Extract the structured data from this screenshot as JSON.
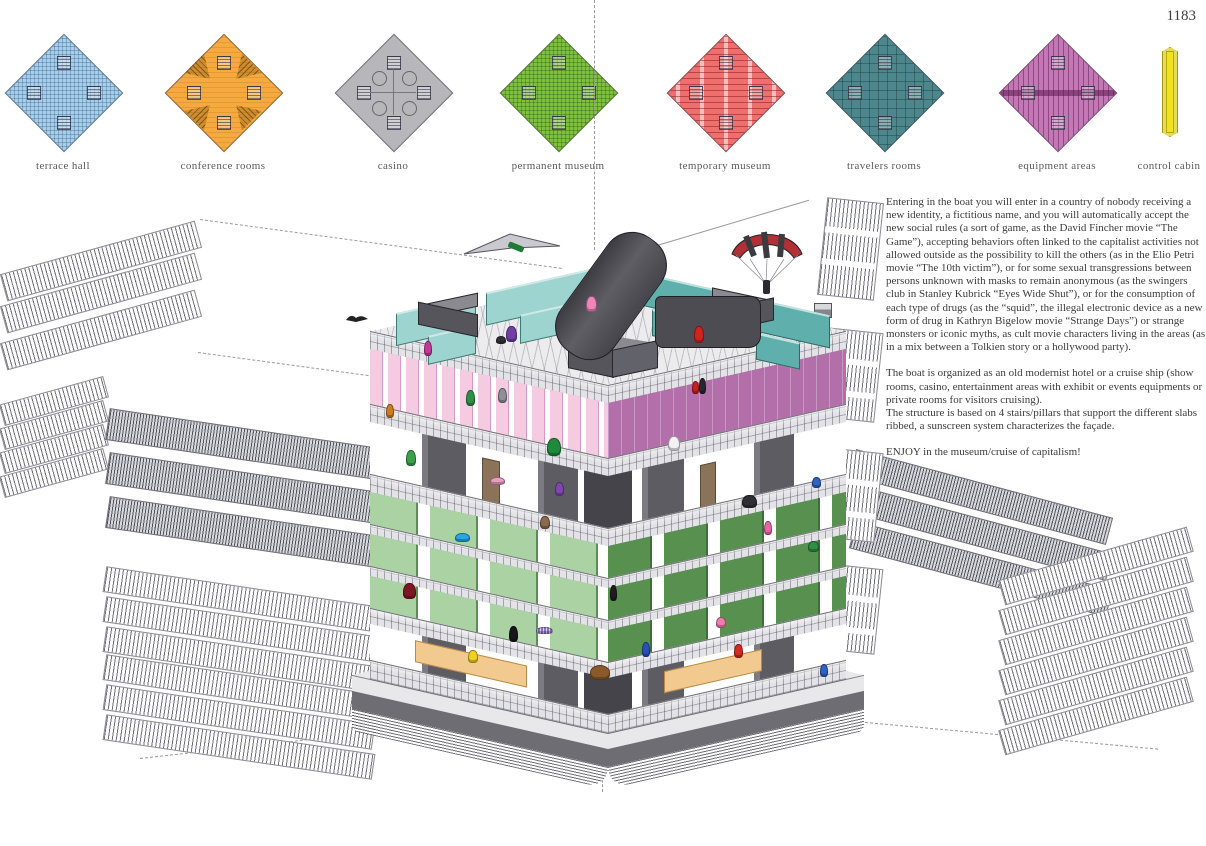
{
  "page": {
    "number": "1183"
  },
  "legend": {
    "items": [
      {
        "id": "terrace-hall",
        "label": "terrace hall",
        "color": "#a5cfe8",
        "pattern": "crosshatch-blue"
      },
      {
        "id": "conference-rooms",
        "label": "conference rooms",
        "color": "#f5a93e",
        "pattern": "fans"
      },
      {
        "id": "casino",
        "label": "casino",
        "color": "#b7b7bb",
        "pattern": "circles"
      },
      {
        "id": "permanent-museum",
        "label": "permanent museum",
        "color": "#7fc13e",
        "pattern": "crosshatch-green"
      },
      {
        "id": "temporary-museum",
        "label": "temporary museum",
        "color": "#ee6f6d",
        "pattern": "dashes"
      },
      {
        "id": "travelers-rooms",
        "label": "travelers rooms",
        "color": "#4e868d",
        "pattern": "rooms"
      },
      {
        "id": "equipment-areas",
        "label": "equipment areas",
        "color": "#c477b5",
        "pattern": "comb"
      },
      {
        "id": "control-cabin",
        "label": "control cabin",
        "color": "#f2e31f",
        "pattern": "rod"
      }
    ]
  },
  "description": {
    "paragraphs": [
      "Entering in the boat you will enter in a country of nobody receiving a new identity, a fictitious name, and you will automatically accept the new social rules (a sort of game, as the David Fincher movie “The Game”), accepting behaviors often linked to the capitalist activities not allowed outside as the possibility to kill the others (as in the Elio Petri movie “The 10th victim”), or for some sexual transgressions between persons unknown with masks to remain anonymous (as the swingers club in Stanley Kubrick “Eyes Wide Shut”), or for the consumption of each type of drugs (as the “squid”, the illegal electronic device as a new form of drug in Kathryn Bigelow movie “Strange Days”) or strange monsters or iconic myths, as cult movie characters living in the areas (as in a mix between a Tolkien story or a hollywood party).",
      "The boat is organized as an old modernist hotel or a cruise ship (show rooms, casino, entertainment areas with exhibit or events equipments or private rooms for visitors cruising).",
      "The structure is based on 4 stairs/pillars that support the different slabs ribbed, a sunscreen system characterizes the façade.",
      "ENJOY in the museum/cruise of capitalism!"
    ]
  },
  "building": {
    "name": "museum-cruise-of-capitalism-axonometric",
    "colors": {
      "teal_walls": "#9ed4d0",
      "teal_walls_dark": "#5fb0ac",
      "pink_band": "#f4cbe1",
      "pink_band_dark": "#b26fa9",
      "green_gallery": "#abd2a3",
      "green_gallery_dark": "#57904f",
      "slab": "#e3e3e7",
      "column": "#5c5c62",
      "hull_dark": "#6d6d73",
      "bar_counter": "#f2c98e",
      "ramp": "#4c4c52"
    },
    "figures": [
      {
        "name": "figure-magenta-runner",
        "color": "#c2399b",
        "x": 424,
        "y": 341,
        "w": 6,
        "h": 13
      },
      {
        "name": "figure-purple-jumper",
        "color": "#6f3fa5",
        "x": 506,
        "y": 326,
        "w": 9,
        "h": 14
      },
      {
        "name": "figure-dark-bird-small",
        "color": "#303038",
        "x": 496,
        "y": 336,
        "w": 8,
        "h": 6
      },
      {
        "name": "figure-pink-dancers",
        "color": "#ef86b9",
        "x": 586,
        "y": 296,
        "w": 9,
        "h": 14
      },
      {
        "name": "figure-red-runner",
        "color": "#cf2520",
        "x": 694,
        "y": 326,
        "w": 8,
        "h": 15
      },
      {
        "name": "figure-green-pointing",
        "color": "#2f8f45",
        "x": 466,
        "y": 390,
        "w": 7,
        "h": 14
      },
      {
        "name": "figure-gray-arms-up",
        "color": "#8f8f96",
        "x": 498,
        "y": 388,
        "w": 7,
        "h": 13
      },
      {
        "name": "figure-orange-monkey",
        "color": "#cd7d22",
        "x": 386,
        "y": 404,
        "w": 6,
        "h": 12
      },
      {
        "name": "figure-red-extinguisher",
        "color": "#c71f1f",
        "x": 692,
        "y": 381,
        "w": 5,
        "h": 11
      },
      {
        "name": "figure-black-standing",
        "color": "#27272d",
        "x": 699,
        "y": 378,
        "w": 5,
        "h": 14
      },
      {
        "name": "figure-white-astronauts",
        "color": "#f2f2f4",
        "x": 668,
        "y": 436,
        "w": 10,
        "h": 13
      },
      {
        "name": "figure-hulk",
        "color": "#1f8a3c",
        "x": 547,
        "y": 438,
        "w": 12,
        "h": 16
      },
      {
        "name": "figure-masked-hero",
        "color": "#3aa04a",
        "x": 406,
        "y": 450,
        "w": 8,
        "h": 14
      },
      {
        "name": "figure-pink-lying",
        "color": "#eb9dc3",
        "x": 490,
        "y": 477,
        "w": 13,
        "h": 6
      },
      {
        "name": "figure-purple-skater",
        "color": "#7f46ad",
        "x": 555,
        "y": 482,
        "w": 7,
        "h": 12
      },
      {
        "name": "figure-blue-bird",
        "color": "#27a7e4",
        "x": 455,
        "y": 533,
        "w": 13,
        "h": 7
      },
      {
        "name": "figure-brown-sloth",
        "color": "#8a6a4e",
        "x": 540,
        "y": 516,
        "w": 8,
        "h": 11
      },
      {
        "name": "figure-darkred-monster",
        "color": "#7e1626",
        "x": 403,
        "y": 583,
        "w": 11,
        "h": 14
      },
      {
        "name": "figure-black-lurker",
        "color": "#1d1d22",
        "x": 610,
        "y": 585,
        "w": 5,
        "h": 14
      },
      {
        "name": "figure-dark-trio",
        "color": "#2f2f35",
        "x": 742,
        "y": 495,
        "w": 13,
        "h": 11
      },
      {
        "name": "figure-pink-climber",
        "color": "#e765a5",
        "x": 764,
        "y": 521,
        "w": 6,
        "h": 12
      },
      {
        "name": "figure-green-crawler",
        "color": "#2f8f45",
        "x": 808,
        "y": 541,
        "w": 9,
        "h": 9
      },
      {
        "name": "figure-blue-hanging",
        "color": "#2f62c4",
        "x": 812,
        "y": 477,
        "w": 7,
        "h": 9
      },
      {
        "name": "figure-striped-worm",
        "color": "#8f6fc8",
        "x": 536,
        "y": 627,
        "w": 15,
        "h": 5
      },
      {
        "name": "figure-black-cloak",
        "color": "#17171b",
        "x": 509,
        "y": 626,
        "w": 7,
        "h": 14
      },
      {
        "name": "figure-pikachu",
        "color": "#efd11f",
        "x": 468,
        "y": 650,
        "w": 8,
        "h": 11
      },
      {
        "name": "figure-blue-visitor",
        "color": "#2851b8",
        "x": 642,
        "y": 642,
        "w": 6,
        "h": 13
      },
      {
        "name": "figure-red-visitor",
        "color": "#d42a22",
        "x": 734,
        "y": 644,
        "w": 7,
        "h": 12
      },
      {
        "name": "figure-pink-spider",
        "color": "#ef7cab",
        "x": 716,
        "y": 617,
        "w": 8,
        "h": 9
      },
      {
        "name": "figure-jabba",
        "color": "#8a5a2a",
        "x": 590,
        "y": 665,
        "w": 18,
        "h": 13
      },
      {
        "name": "figure-blue-guard",
        "color": "#2f62c4",
        "x": 820,
        "y": 664,
        "w": 6,
        "h": 11
      }
    ]
  }
}
